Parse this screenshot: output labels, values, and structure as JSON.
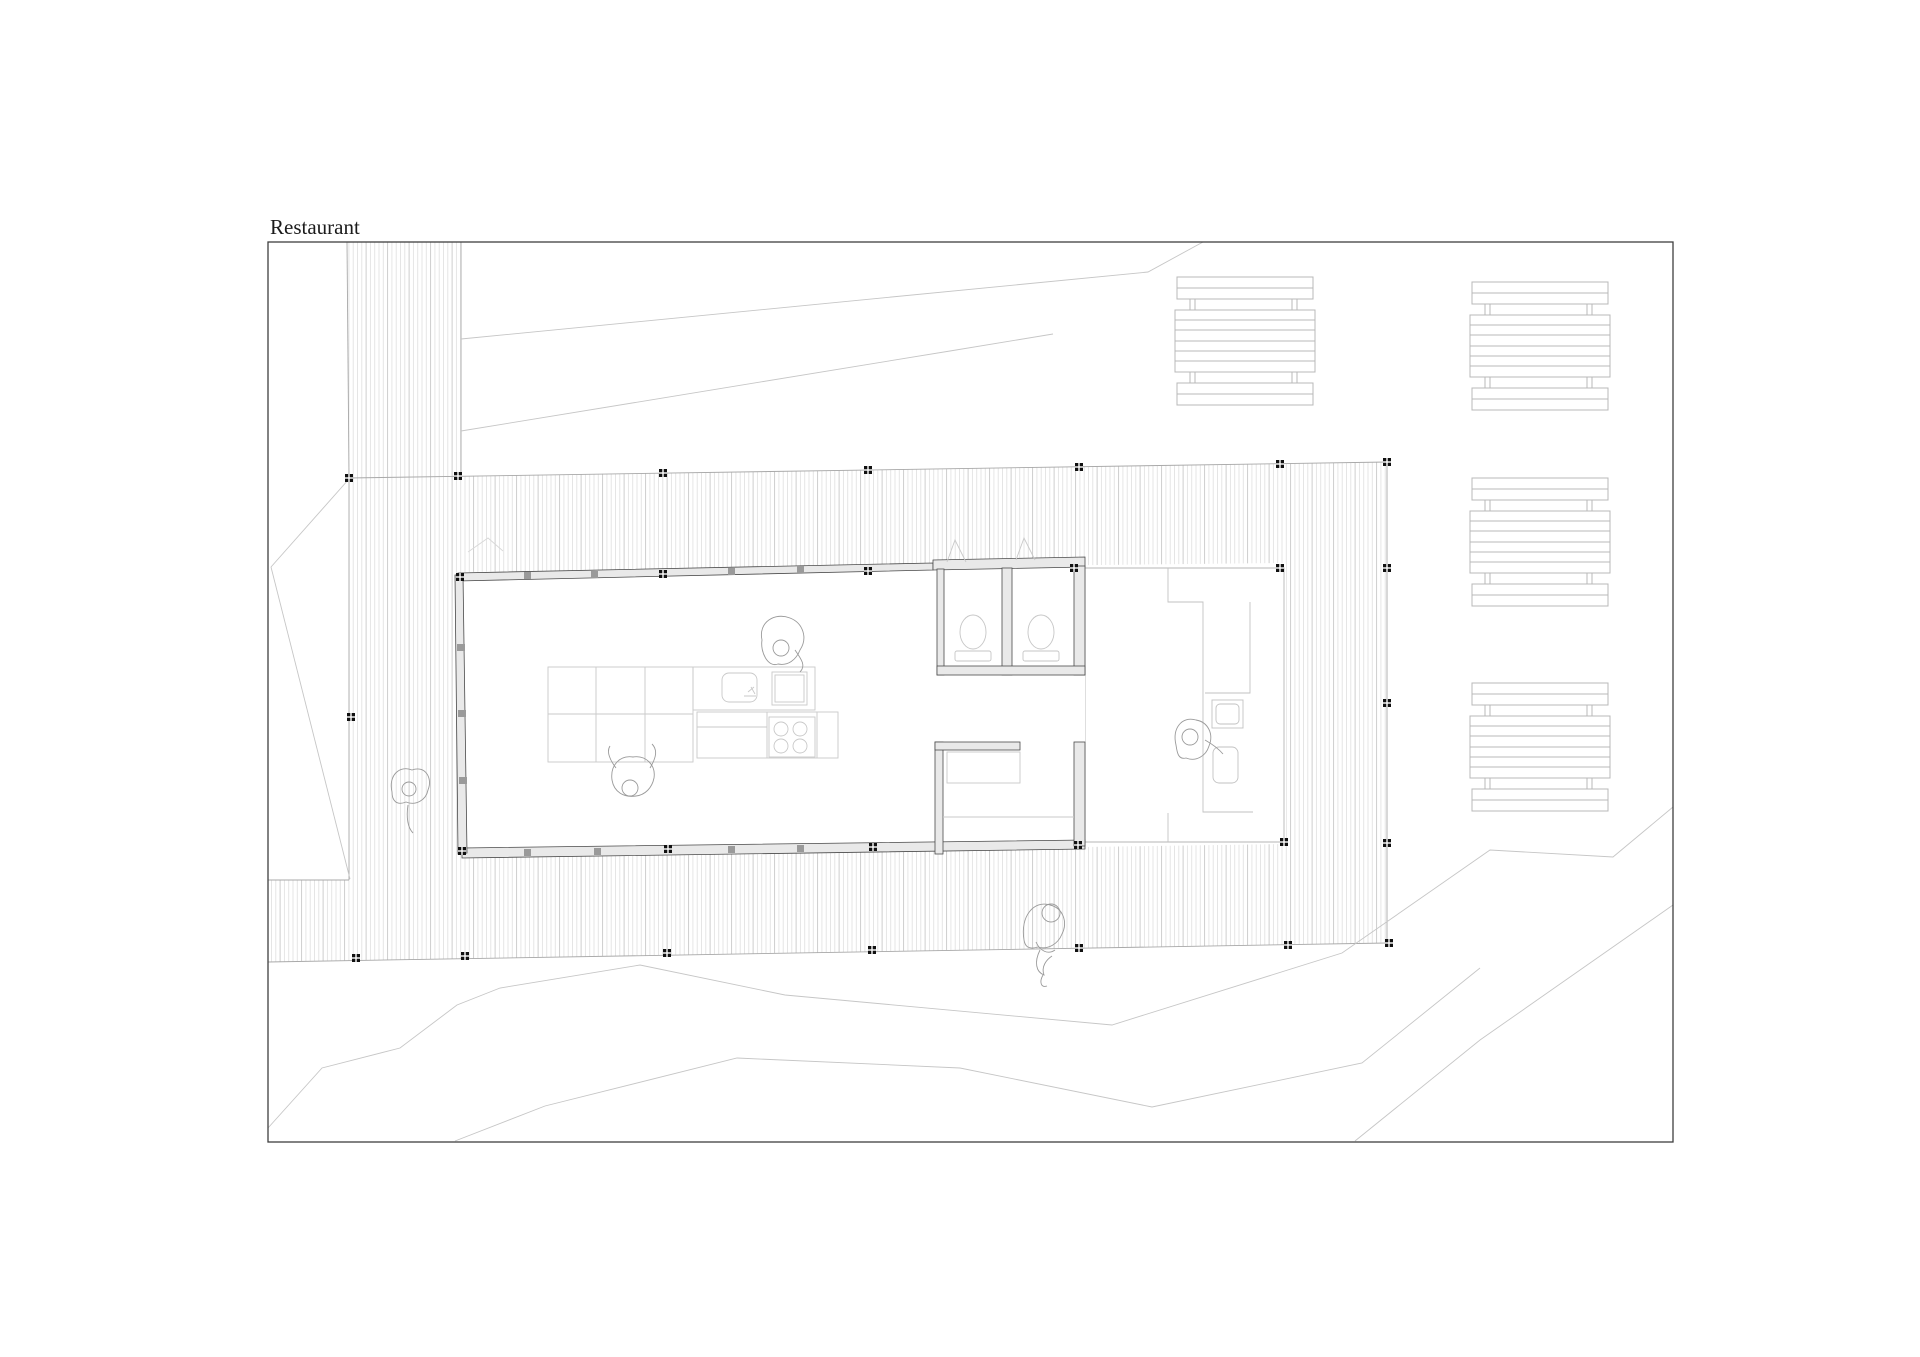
{
  "title": {
    "text": "Restaurant"
  },
  "plan": {
    "kind": "architectural site floor plan, top view",
    "colors": {
      "paper": "#ffffff",
      "frame": "#3f3f3f",
      "wall_stroke": "#4a4a4a",
      "wall_fill": "#e9e9e9",
      "deck_hatch_light": "#e3e3e3",
      "deck_hatch_dark": "#c9c9c9",
      "deck_edge": "#a8a8a8",
      "furniture": "#b8b8b8",
      "fixture": "#c6c6c6",
      "terrain_line": "#c6c6c6",
      "figure_outline": "#9a9a9a",
      "post_marker": "#111111"
    },
    "elements": {
      "building": "glazed restaurant pavilion",
      "walkway": "boardwalk path from top edge",
      "deck": "timber deck apron around building",
      "terrace": "open covered terrace with bar counter",
      "toilets": "two wc cubicles",
      "storage": "back-of-house room",
      "communal_table": "3x2 table grid",
      "kitchen": "counter with sink, cutting board, 4-burner stove",
      "picnic_tables_count": 4,
      "people_count": 5,
      "post_markers_count": 28
    },
    "people": [
      "person-standing-at-kitchen-counter",
      "person-seated-at-communal-table",
      "person-walking-on-boardwalk",
      "person-sitting-on-deck-edge",
      "person-seated-at-terrace-bar"
    ]
  }
}
